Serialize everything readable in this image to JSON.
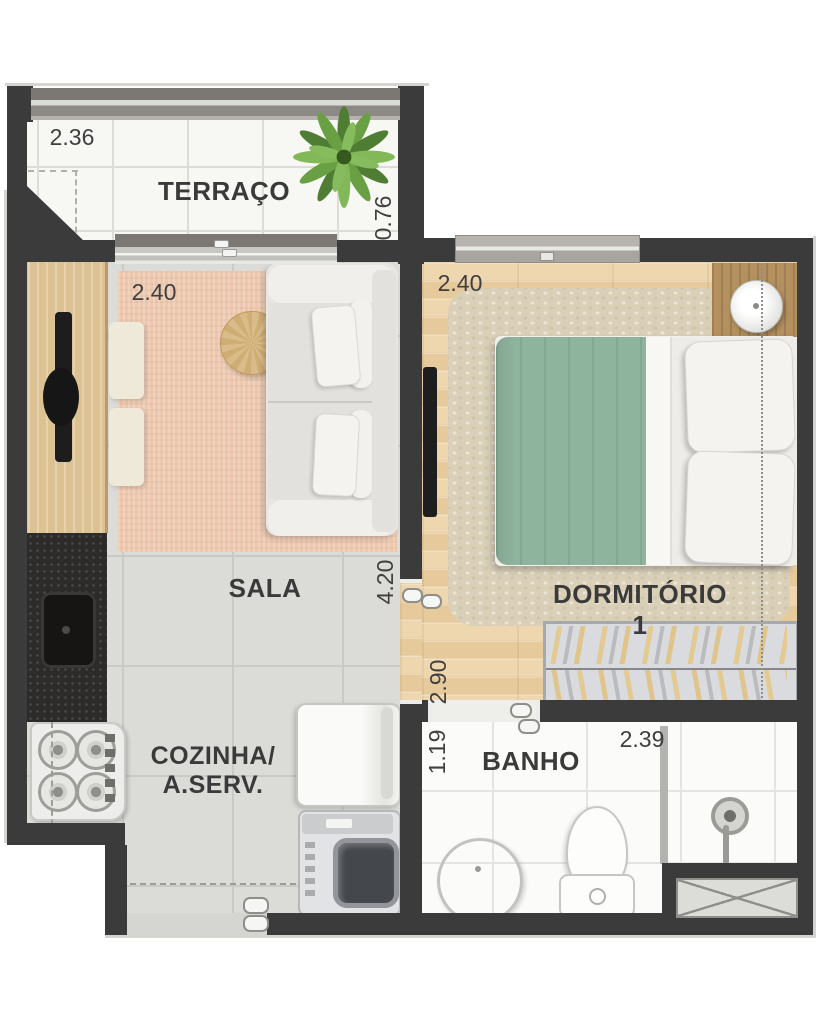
{
  "rooms": {
    "terraco": {
      "name": "TERRAÇO",
      "width": "2.36",
      "depth": "0.76"
    },
    "sala": {
      "name": "SALA",
      "width": "2.40",
      "length": "4.20"
    },
    "dormitorio1": {
      "name": "DORMITÓRIO 1",
      "width": "2.40",
      "length": "2.90"
    },
    "cozinha": {
      "name_line1": "COZINHA/",
      "name_line2": "A.SERV."
    },
    "banho": {
      "name": "BANHO",
      "width": "2.39",
      "depth": "1.19"
    }
  },
  "colors": {
    "wall": "#3b3b3b",
    "terrace_floor": "#f7f7f4",
    "tile_floor": "#dbdbd7",
    "wood_floor": "#ecd2a8",
    "bath_floor": "#fbfbf9",
    "sala_rug": "#edc8af",
    "bedroom_rug": "#dad0b8",
    "blanket": "#8fb49e",
    "counter": "#2d2b29",
    "plant": "#5d9444",
    "text": "#3f3f3f"
  }
}
